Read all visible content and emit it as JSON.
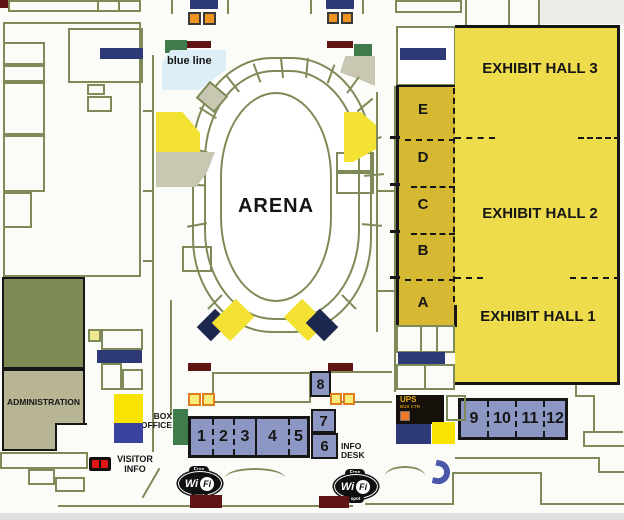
{
  "floorplan": {
    "arena_label": "ARENA",
    "blue_line_label": "blue line",
    "administration_label": "ADMINISTRATION",
    "box_office_line1": "BOX",
    "box_office_line2": "OFFICE",
    "info_desk_line1": "INFO",
    "info_desk_line2": "DESK",
    "visitor_info_line1": "VISITOR",
    "visitor_info_line2": "INFO",
    "ups_name": "UPS",
    "ups_sub": "BUS CTR",
    "halls": [
      "EXHIBIT HALL 3",
      "EXHIBIT HALL 2",
      "EXHIBIT HALL 1"
    ],
    "sections": [
      "E",
      "D",
      "C",
      "B",
      "A"
    ],
    "rooms_15": [
      "1",
      "2",
      "3",
      "4",
      "5"
    ],
    "room_6": "6",
    "room_7": "7",
    "room_8": "8",
    "rooms_912": [
      "9",
      "10",
      "11",
      "12"
    ],
    "wifi": {
      "free": "Free",
      "wi": "Wi",
      "fi": "Fi",
      "spot": "spot"
    }
  },
  "colors": {
    "wall": "#7e8a57",
    "hallyellow": "#eedc4c",
    "gold": "#d6b832",
    "wedgeyellow": "#f3e232",
    "brightyellow": "#f8e400",
    "paleyellow": "#eee98e",
    "roomblue": "#8c97c3",
    "navy": "#2e3a78",
    "navydark": "#1c2750",
    "orange": "#ef941e",
    "green": "#3f7b4b",
    "maroon": "#5e1513",
    "olive": "#7e8a55",
    "khaki": "#b7b594",
    "graywedge": "#c9c7b2",
    "red": "#e31414",
    "lightblue": "#ddeef6",
    "ink": "#161616",
    "upsgold": "#e8b01e",
    "horseshoe": "#4b57a8"
  }
}
